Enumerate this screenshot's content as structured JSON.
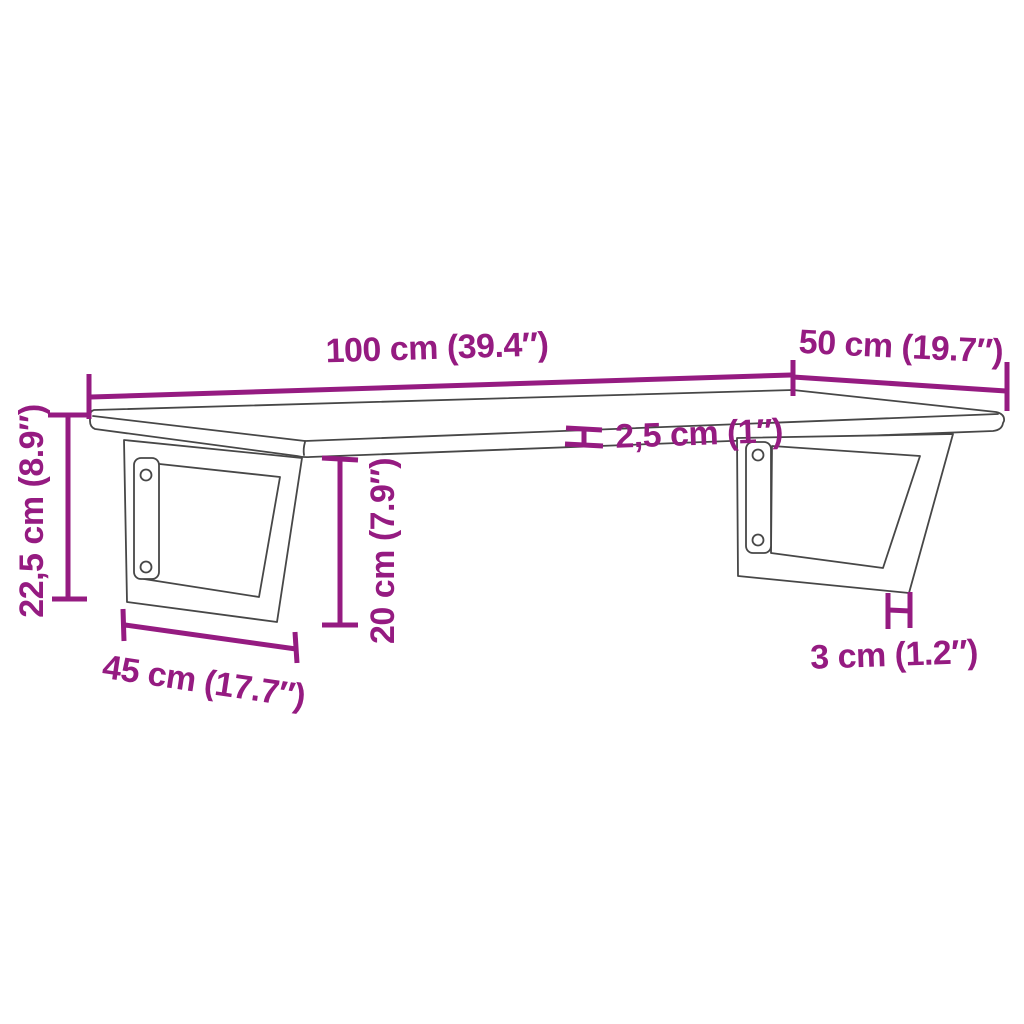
{
  "colors": {
    "dimension_accent": "#951B81",
    "drawing_outline": "#474747",
    "background": "#FFFFFF"
  },
  "diagram": {
    "kind": "product-dimension-diagram",
    "subject": "wall-mounted shelf board with two trapezoid steel brackets",
    "measurements": [
      {
        "id": "shelf-width",
        "label": "100 cm (39.4″)",
        "cm": 100,
        "inches": 39.4
      },
      {
        "id": "shelf-depth",
        "label": "50 cm (19.7″)",
        "cm": 50,
        "inches": 19.7
      },
      {
        "id": "shelf-thickness",
        "label": "2,5 cm (1″)",
        "cm": 2.5,
        "inches": 1
      },
      {
        "id": "overall-height",
        "label": "22,5 cm (8.9″)",
        "cm": 22.5,
        "inches": 8.9
      },
      {
        "id": "bracket-height",
        "label": "20 cm (7.9″)",
        "cm": 20,
        "inches": 7.9
      },
      {
        "id": "bracket-base-width",
        "label": "45 cm (17.7″)",
        "cm": 45,
        "inches": 17.7
      },
      {
        "id": "bracket-bar-width",
        "label": "3 cm (1.2″)",
        "cm": 3,
        "inches": 1.2
      }
    ]
  }
}
